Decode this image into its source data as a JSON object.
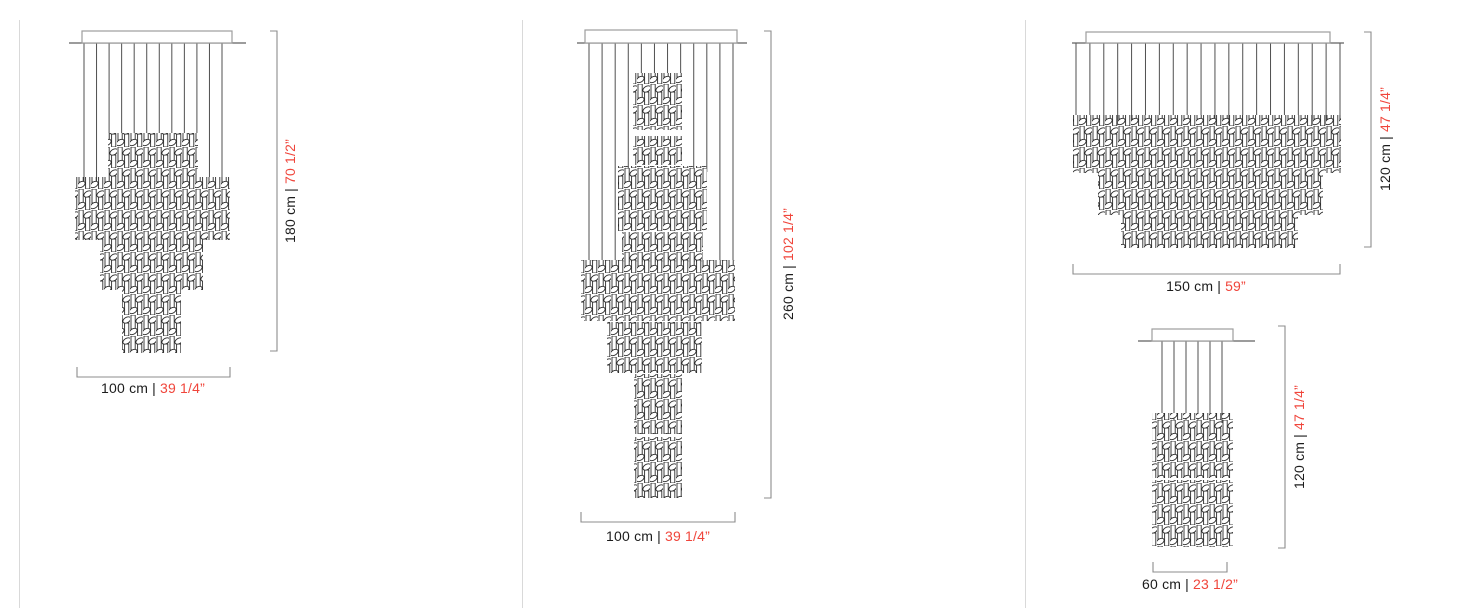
{
  "separator": "|",
  "diagrams": [
    {
      "name": "chandelier-cascade-4-tier",
      "width": {
        "cm": "100 cm",
        "inch": "39 1/4”"
      },
      "height": {
        "cm": "180 cm",
        "inch": "70 1/2”"
      }
    },
    {
      "name": "chandelier-cascade-7-tier",
      "width": {
        "cm": "100 cm",
        "inch": "39 1/4”"
      },
      "height": {
        "cm": "260 cm",
        "inch": "102 1/4”"
      }
    },
    {
      "name": "chandelier-wide-inverted-pyramid",
      "width": {
        "cm": "150 cm",
        "inch": "59”"
      },
      "height": {
        "cm": "120 cm",
        "inch": "47 1/4”"
      }
    },
    {
      "name": "chandelier-narrow-column",
      "width": {
        "cm": "60 cm",
        "inch": "23 1/2”"
      },
      "height": {
        "cm": "120 cm",
        "inch": "47 1/4”"
      }
    }
  ],
  "colors": {
    "background": "#ffffff",
    "cm_text": "#1c1c1c",
    "inch_text": "#f0453b",
    "dim_line": "#8c8c8c",
    "wire_line": "#4f4f4f",
    "ceiling_line": "#606060",
    "canopy_line": "#9d9d9d",
    "cluster_line": "#2b2b2b",
    "divider": "#d9d9d9"
  }
}
